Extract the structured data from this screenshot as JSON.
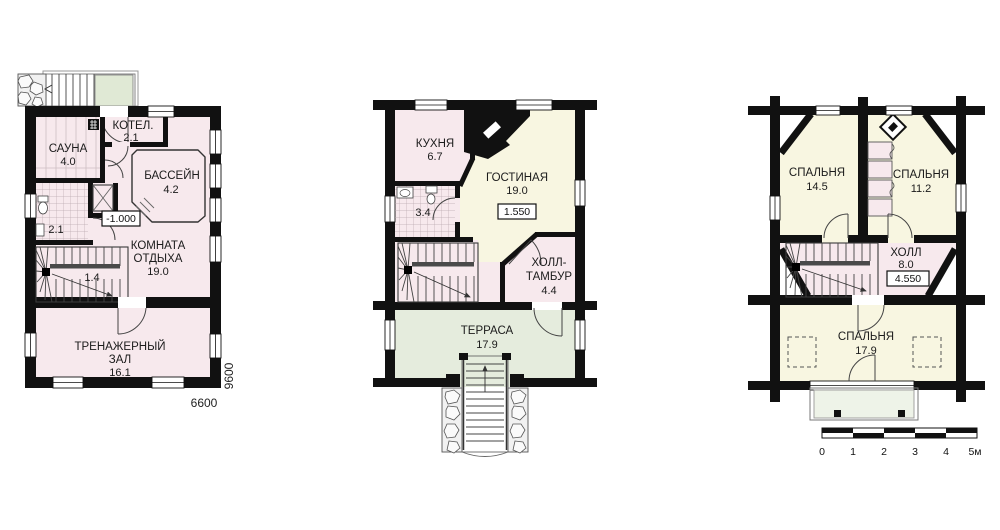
{
  "colors": {
    "wall": "#111111",
    "room_pink": "#f7e9ed",
    "room_cream": "#f8f6e1",
    "terrace_green": "#e5ecdd",
    "entry_pad_green": "#e0e9d5",
    "balcony_green": "#eef3e8"
  },
  "floor1": {
    "sauna_name": "САУНА",
    "sauna_area": "4.0",
    "boiler_name": "КОТЕЛ.",
    "boiler_area": "2.1",
    "pool_name": "БАССЕЙН",
    "pool_area": "4.2",
    "bath_area": "2.1",
    "elevation": "-1.000",
    "lounge_l1": "КОМНАТА",
    "lounge_l2": "ОТДЫХА",
    "lounge_area": "19.0",
    "stairs_area": "1.4",
    "gym_l1": "ТРЕНАЖЕРНЫЙ",
    "gym_l2": "ЗАЛ",
    "gym_area": "16.1",
    "dim_width": "6600",
    "dim_height": "9600"
  },
  "floor2": {
    "kitchen_name": "КУХНЯ",
    "kitchen_area": "6.7",
    "living_name": "ГОСТИНАЯ",
    "living_area": "19.0",
    "elevation": "1.550",
    "bath_area": "3.4",
    "hall_l1": "ХОЛЛ-",
    "hall_l2": "ТАМБУР",
    "hall_area": "4.4",
    "terrace_name": "ТЕРРАСА",
    "terrace_area": "17.9"
  },
  "floor3": {
    "bedroom1_name": "СПАЛЬНЯ",
    "bedroom1_area": "14.5",
    "bedroom2_name": "СПАЛЬНЯ",
    "bedroom2_area": "11.2",
    "hall_name": "ХОЛЛ",
    "hall_area": "8.0",
    "elevation": "4.550",
    "bedroom3_name": "СПАЛЬНЯ",
    "bedroom3_area": "17.9"
  },
  "scalebar": {
    "t0": "0",
    "t1": "1",
    "t2": "2",
    "t3": "3",
    "t4": "4",
    "t5": "5м"
  }
}
